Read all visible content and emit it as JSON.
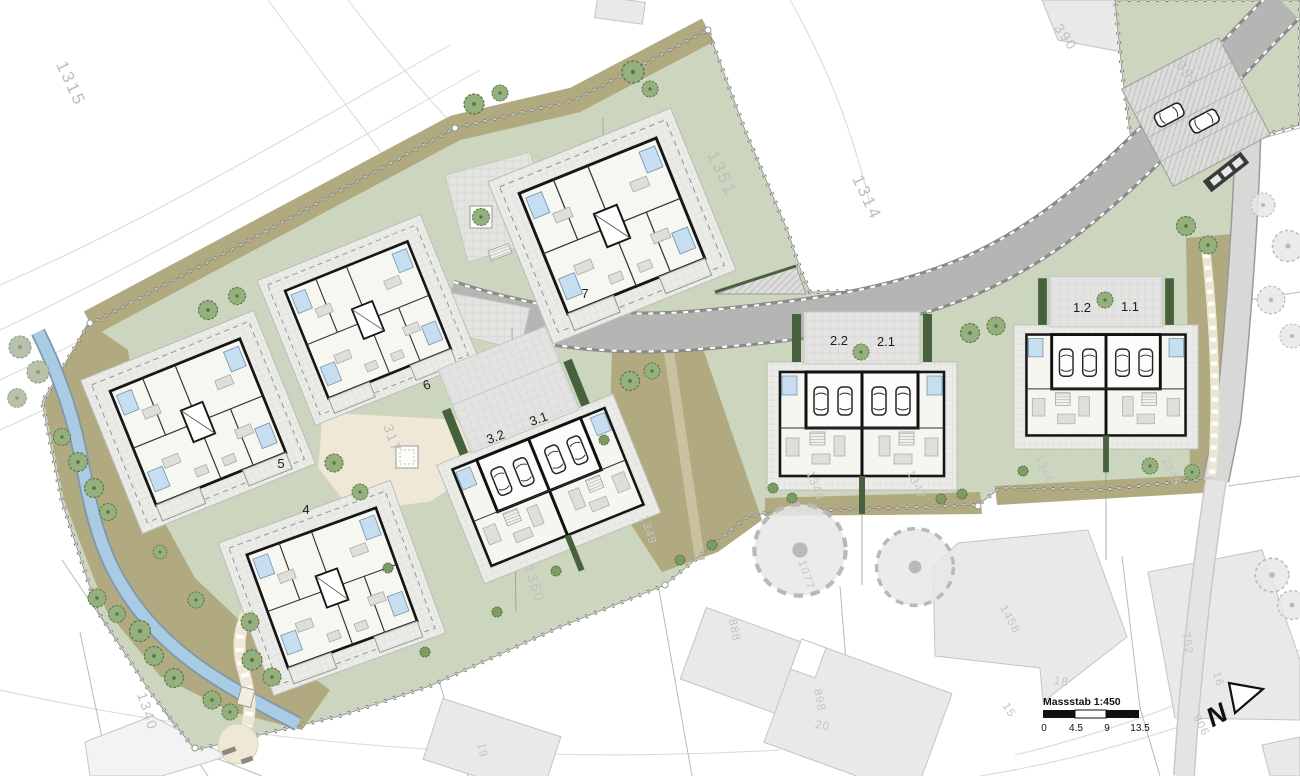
{
  "document": {
    "type": "Architectural site plan (Situationsplan) of a residential development",
    "language": "German"
  },
  "scale_bar": {
    "title": "Massstab 1:450",
    "ticks": [
      "0",
      "4.5",
      "9",
      "13.5"
    ]
  },
  "north_arrow": {
    "label": "N"
  },
  "unit_labels": {
    "u7": "7",
    "u6": "6",
    "u5": "5",
    "u4": "4",
    "u3_2": "3.2",
    "u3_1": "3.1",
    "u2_2": "2.2",
    "u2_1": "2.1",
    "u1_2": "1.2",
    "u1_1": "1.1"
  },
  "parcel_labels": {
    "p1315": "1315",
    "p1351": "1351",
    "p1314": "1314",
    "p390": "390",
    "p391": "391",
    "p317": "317",
    "p1340": "1340",
    "p1350": "1350",
    "p1349": "1349",
    "p1348": "1348",
    "p1347": "1347",
    "p1346": "1346",
    "p1345": "1345",
    "p1077": "1077",
    "p888": "888",
    "p898": "898",
    "p20": "20",
    "p19": "19",
    "p1458": "1458",
    "p18": "18",
    "p15": "15",
    "p752": "752",
    "p16": "16",
    "p906": "906"
  },
  "colors": {
    "site_lawn": "#ccd5bd",
    "meadow": "#b1aa80",
    "stream": "#a9cbe3",
    "road": "#b5b5b4",
    "side_road": "#d8d8d7",
    "paving": "#e3e3e1",
    "terrace": "#ebece7",
    "path": "#efe8d6",
    "building_wall": "#161616",
    "building_fill": "#f6f6f0",
    "existing_building": "#e9e9e9",
    "tree": "#94b07c",
    "hedge": "#46613c",
    "bed_blue": "#c7def0",
    "parcel_text": "#c2c2c2",
    "unit_text": "#1d1d1d"
  }
}
